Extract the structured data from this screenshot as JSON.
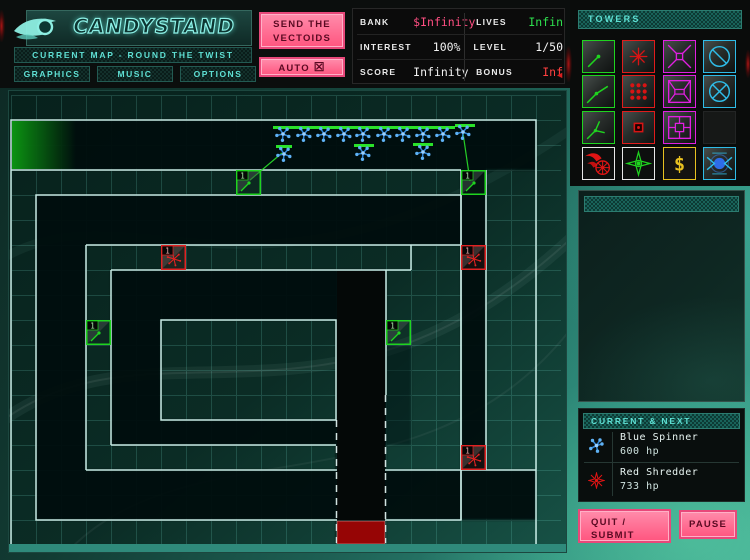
{
  "header": {
    "logo": "CANDYSTAND",
    "map_label": "CURRENT MAP - ROUND THE TWIST",
    "nav_buttons": [
      {
        "label": "GRAPHICS"
      },
      {
        "label": "MUSIC"
      },
      {
        "label": "OPTIONS"
      }
    ],
    "send_button": {
      "line1": "SEND THE",
      "line2": "VECTOIDS"
    },
    "auto_button": {
      "label": "AUTO",
      "checkbox": "☒"
    }
  },
  "stats": {
    "rows": [
      {
        "left_label": "BANK",
        "left_value": "$Infinity",
        "right_label": "LIVES",
        "right_value": "Infin"
      },
      {
        "left_label": "INTEREST",
        "left_value": "100%",
        "right_label": "LEVEL",
        "right_value": "1/50"
      },
      {
        "left_label": "SCORE",
        "left_value": "Infinity",
        "right_label": "BONUS",
        "right_value": "Inf"
      }
    ],
    "bonus_arrow": "◄"
  },
  "towers_panel": {
    "title": "TOWERS",
    "cash_symbol": "$",
    "slots": [
      {
        "name": "green-laser-tower"
      },
      {
        "name": "red-spike-tower"
      },
      {
        "name": "magenta-pyramid-tower"
      },
      {
        "name": "cyan-slash-orb-tower"
      },
      {
        "name": "green-refractor-tower"
      },
      {
        "name": "red-grid-tower"
      },
      {
        "name": "magenta-frustum-tower"
      },
      {
        "name": "cyan-cross-orb-tower"
      },
      {
        "name": "green-splitter-tower"
      },
      {
        "name": "red-core-tower"
      },
      {
        "name": "magenta-cell-tower"
      },
      {
        "name": "empty-slot"
      },
      {
        "name": "fire-shard-tower"
      },
      {
        "name": "green-burst-tower"
      },
      {
        "name": "cash-tower"
      },
      {
        "name": "blue-orb-tower"
      }
    ]
  },
  "current_next": {
    "title": "CURRENT & NEXT",
    "entries": [
      {
        "icon": "blue-spinner-icon",
        "name": "Blue Spinner",
        "hp": "600 hp"
      },
      {
        "icon": "red-shredder-icon",
        "name": "Red Shredder",
        "hp": "733 hp"
      }
    ]
  },
  "actions": {
    "quit_line1": "QUIT /",
    "quit_line2": "SUBMIT",
    "pause": "PAUSE"
  },
  "colors": {
    "accent_pink": "#ff557f",
    "accent_cyan": "#5fe0d4",
    "bank_value": "#ff4f82",
    "lives_value": "#2ee04e",
    "bonus_value": "#ff4040",
    "wall": "#d2f4ee",
    "entrance": "#0c9a12",
    "exit": "#960505",
    "tower_green": "#1fd41f",
    "tower_red": "#e02222",
    "creep_blue": "#5fb2f5",
    "laser": "#2ae22a"
  },
  "map": {
    "towers": [
      {
        "type": "green",
        "x": 236,
        "y": 170,
        "level": "1"
      },
      {
        "type": "green",
        "x": 461,
        "y": 170,
        "level": "1"
      },
      {
        "type": "green",
        "x": 86,
        "y": 320,
        "level": "1"
      },
      {
        "type": "green",
        "x": 386,
        "y": 320,
        "level": "1"
      },
      {
        "type": "red",
        "x": 161,
        "y": 245,
        "level": "1"
      },
      {
        "type": "red",
        "x": 461,
        "y": 245,
        "level": "1"
      },
      {
        "type": "red",
        "x": 461,
        "y": 445,
        "level": "1"
      }
    ],
    "creeps": [
      [
        283,
        134
      ],
      [
        304,
        134
      ],
      [
        324,
        134
      ],
      [
        344,
        134
      ],
      [
        363,
        134
      ],
      [
        384,
        134
      ],
      [
        403,
        134
      ],
      [
        423,
        134
      ],
      [
        443,
        134
      ],
      [
        463,
        132
      ],
      [
        284,
        154
      ],
      [
        363,
        153
      ],
      [
        423,
        152
      ]
    ],
    "health_bars": [
      [
        273,
        126,
        182
      ],
      [
        455,
        124,
        20
      ],
      [
        276,
        145,
        16
      ],
      [
        354,
        144,
        20
      ],
      [
        413,
        143,
        20
      ]
    ],
    "lasers": [
      [
        250,
        180,
        282,
        153
      ],
      [
        470,
        181,
        463,
        133
      ]
    ]
  }
}
